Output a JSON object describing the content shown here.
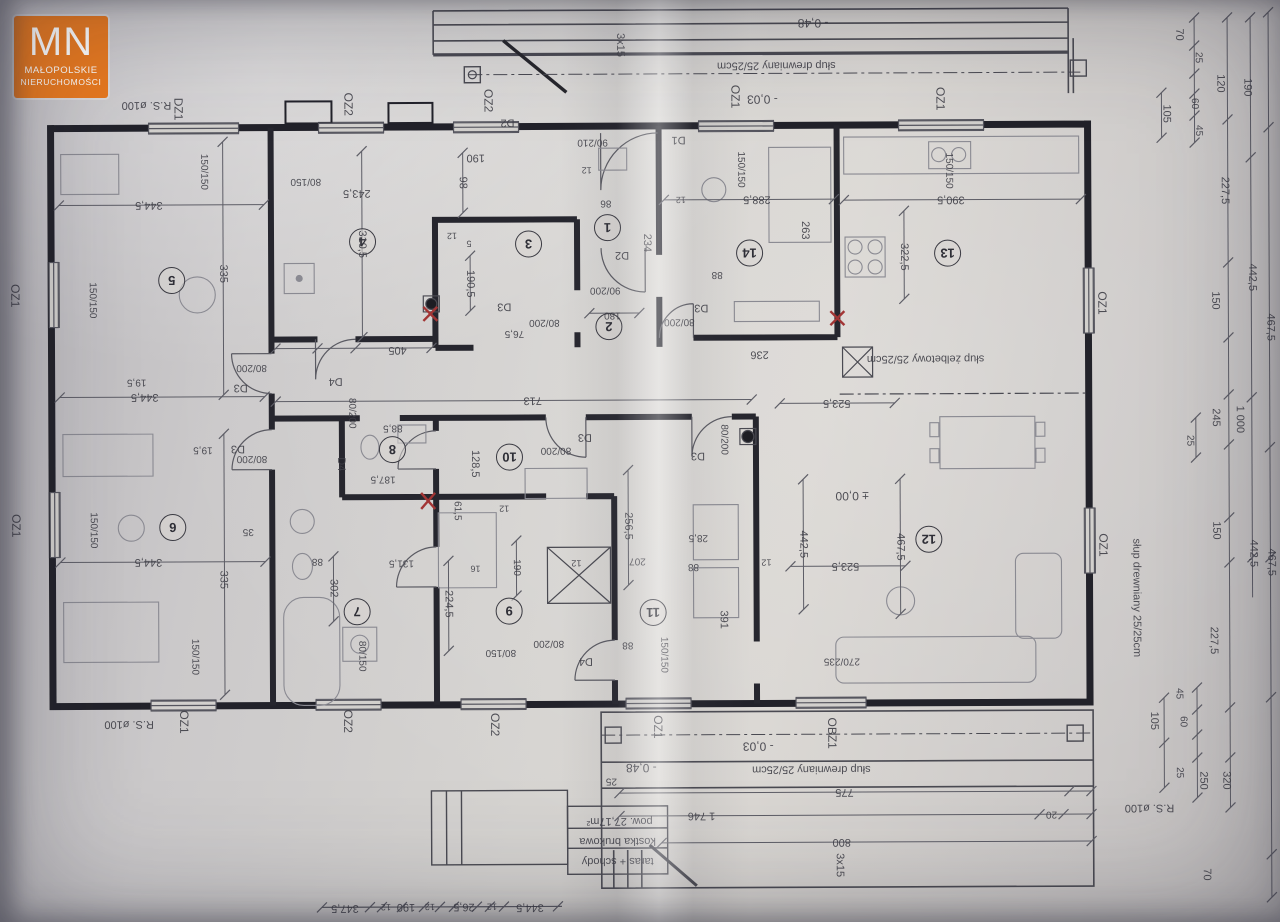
{
  "logo": {
    "initials": "MN",
    "line1": "MAŁOPOLSKIE",
    "line2": "NIERUCHOMOŚCI"
  },
  "colors": {
    "paper": "#d6d4d1",
    "ink": "#3f3f47",
    "wall": "#22222a",
    "accent": "#e8791f",
    "red": "#a23535"
  },
  "rooms": [
    {
      "n": "1",
      "x": 608,
      "y": 227
    },
    {
      "n": "2",
      "x": 609,
      "y": 326
    },
    {
      "n": "3",
      "x": 529,
      "y": 243
    },
    {
      "n": "4",
      "x": 363,
      "y": 240
    },
    {
      "n": "5",
      "x": 172,
      "y": 278
    },
    {
      "n": "6",
      "x": 172,
      "y": 525
    },
    {
      "n": "7",
      "x": 356,
      "y": 610
    },
    {
      "n": "8",
      "x": 392,
      "y": 448
    },
    {
      "n": "9",
      "x": 508,
      "y": 610
    },
    {
      "n": "10",
      "x": 509,
      "y": 456
    },
    {
      "n": "11",
      "x": 652,
      "y": 612
    },
    {
      "n": "12",
      "x": 928,
      "y": 540
    },
    {
      "n": "13",
      "x": 948,
      "y": 254
    },
    {
      "n": "14",
      "x": 750,
      "y": 253
    }
  ],
  "labels": [
    {
      "t": "R.S. ø100",
      "x": 148,
      "y": 103,
      "r": 180,
      "s": 11
    },
    {
      "t": "DZ1",
      "x": 180,
      "y": 107,
      "r": 90,
      "s": 12
    },
    {
      "t": "OZ2",
      "x": 350,
      "y": 103,
      "r": 90,
      "s": 12
    },
    {
      "t": "OZ2",
      "x": 490,
      "y": 100,
      "r": 90,
      "s": 12
    },
    {
      "t": "OZ1",
      "x": 737,
      "y": 97,
      "r": 90,
      "s": 12
    },
    {
      "t": "OZ1",
      "x": 942,
      "y": 100,
      "r": 90,
      "s": 12
    },
    {
      "t": "3x15",
      "x": 622,
      "y": 45,
      "r": 90,
      "s": 11
    },
    {
      "t": "- 0,48",
      "x": 815,
      "y": 24,
      "r": 180,
      "s": 12
    },
    {
      "t": "słup drewniany 25/25cm",
      "x": 778,
      "y": 66,
      "r": 180,
      "s": 11
    },
    {
      "t": "- 0,03",
      "x": 764,
      "y": 100,
      "r": 180,
      "s": 12
    },
    {
      "t": "90/210",
      "x": 594,
      "y": 142,
      "r": 180,
      "s": 10
    },
    {
      "t": "OZ1",
      "x": 16,
      "y": 293,
      "r": 90,
      "s": 12
    },
    {
      "t": "OZ1",
      "x": 16,
      "y": 523,
      "r": 90,
      "s": 12
    },
    {
      "t": "OZ1",
      "x": 1103,
      "y": 305,
      "r": 90,
      "s": 12
    },
    {
      "t": "OZ1",
      "x": 1103,
      "y": 547,
      "r": 90,
      "s": 12
    },
    {
      "t": "słup drewniany 25/25cm",
      "x": 1136,
      "y": 600,
      "r": 90,
      "s": 11
    },
    {
      "t": "70",
      "x": 1181,
      "y": 37,
      "r": 90,
      "s": 11
    },
    {
      "t": "25",
      "x": 1200,
      "y": 60,
      "r": 90,
      "s": 10
    },
    {
      "t": "120",
      "x": 1222,
      "y": 86,
      "r": 90,
      "s": 11
    },
    {
      "t": "190",
      "x": 1249,
      "y": 90,
      "r": 90,
      "s": 11
    },
    {
      "t": "60",
      "x": 1196,
      "y": 106,
      "r": 90,
      "s": 10
    },
    {
      "t": "105",
      "x": 1168,
      "y": 116,
      "r": 90,
      "s": 11
    },
    {
      "t": "45",
      "x": 1200,
      "y": 133,
      "r": 90,
      "s": 10
    },
    {
      "t": "227,5",
      "x": 1226,
      "y": 193,
      "r": 90,
      "s": 11
    },
    {
      "t": "442,5",
      "x": 1253,
      "y": 280,
      "r": 90,
      "s": 11
    },
    {
      "t": "467,5",
      "x": 1271,
      "y": 330,
      "r": 90,
      "s": 11
    },
    {
      "t": "150",
      "x": 1216,
      "y": 303,
      "r": 90,
      "s": 11
    },
    {
      "t": "245",
      "x": 1216,
      "y": 420,
      "r": 90,
      "s": 11
    },
    {
      "t": "25",
      "x": 1190,
      "y": 443,
      "r": 90,
      "s": 10
    },
    {
      "t": "1 000",
      "x": 1240,
      "y": 422,
      "r": 90,
      "s": 11
    },
    {
      "t": "150",
      "x": 1216,
      "y": 533,
      "r": 90,
      "s": 11
    },
    {
      "t": "442,5",
      "x": 1253,
      "y": 556,
      "r": 90,
      "s": 11
    },
    {
      "t": "467,5",
      "x": 1271,
      "y": 565,
      "r": 90,
      "s": 11
    },
    {
      "t": "227,5",
      "x": 1213,
      "y": 643,
      "r": 90,
      "s": 11
    },
    {
      "t": "45",
      "x": 1178,
      "y": 696,
      "r": 90,
      "s": 10
    },
    {
      "t": "60",
      "x": 1182,
      "y": 724,
      "r": 90,
      "s": 10
    },
    {
      "t": "105",
      "x": 1153,
      "y": 723,
      "r": 90,
      "s": 11
    },
    {
      "t": "25",
      "x": 1178,
      "y": 775,
      "r": 90,
      "s": 10
    },
    {
      "t": "250",
      "x": 1202,
      "y": 783,
      "r": 90,
      "s": 11
    },
    {
      "t": "320",
      "x": 1225,
      "y": 783,
      "r": 90,
      "s": 11
    },
    {
      "t": "70",
      "x": 1205,
      "y": 877,
      "r": 90,
      "s": 11
    },
    {
      "t": "R.S. ø100",
      "x": 1148,
      "y": 810,
      "r": 180,
      "s": 11
    },
    {
      "t": "OZ1",
      "x": 183,
      "y": 720,
      "r": 90,
      "s": 12
    },
    {
      "t": "R.S. ø100",
      "x": 128,
      "y": 722,
      "r": 180,
      "s": 11
    },
    {
      "t": "OZ2",
      "x": 347,
      "y": 720,
      "r": 90,
      "s": 12
    },
    {
      "t": "OZ2",
      "x": 494,
      "y": 724,
      "r": 90,
      "s": 12
    },
    {
      "t": "OZ1",
      "x": 657,
      "y": 727,
      "r": 90,
      "s": 12
    },
    {
      "t": "OBZ1",
      "x": 831,
      "y": 734,
      "r": 90,
      "s": 12
    },
    {
      "t": "- 0,48",
      "x": 640,
      "y": 768,
      "r": 180,
      "s": 12
    },
    {
      "t": "25",
      "x": 610,
      "y": 781,
      "r": 180,
      "s": 10
    },
    {
      "t": "słup drewniany 25/25cm",
      "x": 810,
      "y": 770,
      "r": 180,
      "s": 11
    },
    {
      "t": "- 0,03",
      "x": 757,
      "y": 747,
      "r": 180,
      "s": 12
    },
    {
      "t": "775",
      "x": 843,
      "y": 793,
      "r": 180,
      "s": 11
    },
    {
      "t": "1 746",
      "x": 700,
      "y": 816,
      "r": 180,
      "s": 11
    },
    {
      "t": "800",
      "x": 840,
      "y": 843,
      "r": 180,
      "s": 11
    },
    {
      "t": "20",
      "x": 1050,
      "y": 816,
      "r": 180,
      "s": 10
    },
    {
      "t": "3x15",
      "x": 838,
      "y": 866,
      "r": 90,
      "s": 11
    },
    {
      "t": "taras + schody",
      "x": 616,
      "y": 861,
      "r": 180,
      "s": 11
    },
    {
      "t": "kostka brukowa",
      "x": 616,
      "y": 841,
      "r": 180,
      "s": 11
    },
    {
      "t": "pow. 27,17m²",
      "x": 618,
      "y": 821,
      "r": 180,
      "s": 11
    },
    {
      "t": "347,5",
      "x": 343,
      "y": 907,
      "r": 180,
      "s": 11
    },
    {
      "t": "12",
      "x": 384,
      "y": 906,
      "r": 180,
      "s": 9
    },
    {
      "t": "190",
      "x": 404,
      "y": 906,
      "r": 180,
      "s": 11
    },
    {
      "t": "12",
      "x": 428,
      "y": 906,
      "r": 180,
      "s": 9
    },
    {
      "t": "26,5",
      "x": 462,
      "y": 906,
      "r": 180,
      "s": 11
    },
    {
      "t": "12",
      "x": 490,
      "y": 906,
      "r": 180,
      "s": 9
    },
    {
      "t": "344,5",
      "x": 528,
      "y": 907,
      "r": 180,
      "s": 11
    },
    {
      "t": "344,5",
      "x": 150,
      "y": 203,
      "r": 180,
      "s": 11
    },
    {
      "t": "335",
      "x": 224,
      "y": 272,
      "r": 90,
      "s": 11
    },
    {
      "t": "150/150",
      "x": 205,
      "y": 170,
      "r": 90,
      "s": 10
    },
    {
      "t": "150/150",
      "x": 93,
      "y": 298,
      "r": 90,
      "s": 10
    },
    {
      "t": "344,5",
      "x": 145,
      "y": 395,
      "r": 180,
      "s": 11
    },
    {
      "t": "19,5",
      "x": 137,
      "y": 380,
      "r": 180,
      "s": 10
    },
    {
      "t": "D3",
      "x": 241,
      "y": 386,
      "r": 180,
      "s": 11
    },
    {
      "t": "80/200",
      "x": 252,
      "y": 366,
      "r": 180,
      "s": 10
    },
    {
      "t": "344,5",
      "x": 148,
      "y": 560,
      "r": 180,
      "s": 11
    },
    {
      "t": "335",
      "x": 223,
      "y": 578,
      "r": 90,
      "s": 11
    },
    {
      "t": "150/150",
      "x": 93,
      "y": 528,
      "r": 90,
      "s": 10
    },
    {
      "t": "150/150",
      "x": 194,
      "y": 655,
      "r": 90,
      "s": 10
    },
    {
      "t": "19,5",
      "x": 203,
      "y": 448,
      "r": 180,
      "s": 10
    },
    {
      "t": "D3",
      "x": 238,
      "y": 447,
      "r": 180,
      "s": 11
    },
    {
      "t": "80/200",
      "x": 252,
      "y": 457,
      "r": 180,
      "s": 10
    },
    {
      "t": "35",
      "x": 248,
      "y": 530,
      "r": 180,
      "s": 10
    },
    {
      "t": "405",
      "x": 398,
      "y": 349,
      "r": 180,
      "s": 11
    },
    {
      "t": "713",
      "x": 533,
      "y": 400,
      "r": 180,
      "s": 11
    },
    {
      "t": "D4",
      "x": 336,
      "y": 380,
      "r": 180,
      "s": 11
    },
    {
      "t": "80/200",
      "x": 352,
      "y": 412,
      "r": 90,
      "s": 10
    },
    {
      "t": "243,5",
      "x": 358,
      "y": 192,
      "r": 180,
      "s": 11
    },
    {
      "t": "310,5",
      "x": 363,
      "y": 243,
      "r": 90,
      "s": 11
    },
    {
      "t": "80/150",
      "x": 307,
      "y": 180,
      "r": 180,
      "s": 10
    },
    {
      "t": "98",
      "x": 464,
      "y": 182,
      "r": 90,
      "s": 11
    },
    {
      "t": "190",
      "x": 477,
      "y": 157,
      "r": 180,
      "s": 11
    },
    {
      "t": "12",
      "x": 453,
      "y": 235,
      "r": 180,
      "s": 9
    },
    {
      "t": "5",
      "x": 470,
      "y": 243,
      "r": 180,
      "s": 9
    },
    {
      "t": "190,5",
      "x": 471,
      "y": 283,
      "r": 90,
      "s": 11
    },
    {
      "t": "D3",
      "x": 505,
      "y": 306,
      "r": 180,
      "s": 11
    },
    {
      "t": "80/200",
      "x": 545,
      "y": 322,
      "r": 180,
      "s": 10
    },
    {
      "t": "76,5",
      "x": 515,
      "y": 333,
      "r": 180,
      "s": 10
    },
    {
      "t": "D2",
      "x": 509,
      "y": 122,
      "r": 180,
      "s": 11
    },
    {
      "t": "86",
      "x": 607,
      "y": 203,
      "r": 180,
      "s": 10
    },
    {
      "t": "234",
      "x": 648,
      "y": 243,
      "r": 90,
      "s": 11
    },
    {
      "t": "D1",
      "x": 680,
      "y": 140,
      "r": 180,
      "s": 11
    },
    {
      "t": "12",
      "x": 588,
      "y": 170,
      "r": 180,
      "s": 9
    },
    {
      "t": "D2",
      "x": 623,
      "y": 255,
      "r": 180,
      "s": 11
    },
    {
      "t": "90/200",
      "x": 606,
      "y": 290,
      "r": 180,
      "s": 10
    },
    {
      "t": "180",
      "x": 613,
      "y": 315,
      "r": 180,
      "s": 10
    },
    {
      "t": "288,5",
      "x": 758,
      "y": 200,
      "r": 180,
      "s": 11
    },
    {
      "t": "150/150",
      "x": 742,
      "y": 170,
      "r": 90,
      "s": 10
    },
    {
      "t": "263",
      "x": 806,
      "y": 231,
      "r": 90,
      "s": 11
    },
    {
      "t": "12",
      "x": 682,
      "y": 200,
      "r": 180,
      "s": 9
    },
    {
      "t": "88",
      "x": 718,
      "y": 275,
      "r": 180,
      "s": 10
    },
    {
      "t": "D3",
      "x": 702,
      "y": 308,
      "r": 180,
      "s": 11
    },
    {
      "t": "80/200",
      "x": 680,
      "y": 322,
      "r": 180,
      "s": 10
    },
    {
      "t": "236",
      "x": 760,
      "y": 355,
      "r": 180,
      "s": 11
    },
    {
      "t": "390,5",
      "x": 952,
      "y": 201,
      "r": 180,
      "s": 11
    },
    {
      "t": "322,5",
      "x": 905,
      "y": 258,
      "r": 90,
      "s": 11
    },
    {
      "t": "150/150",
      "x": 950,
      "y": 172,
      "r": 90,
      "s": 10
    },
    {
      "t": "słup żelbetowy 25/25cm",
      "x": 926,
      "y": 360,
      "r": 180,
      "s": 11
    },
    {
      "t": "523,5",
      "x": 837,
      "y": 404,
      "r": 180,
      "s": 11
    },
    {
      "t": "± 0,00",
      "x": 852,
      "y": 497,
      "r": 180,
      "s": 12
    },
    {
      "t": "442,5",
      "x": 803,
      "y": 545,
      "r": 90,
      "s": 11
    },
    {
      "t": "523,5",
      "x": 845,
      "y": 567,
      "r": 180,
      "s": 11
    },
    {
      "t": "467,5",
      "x": 900,
      "y": 548,
      "r": 90,
      "s": 11
    },
    {
      "t": "270/235",
      "x": 841,
      "y": 662,
      "r": 180,
      "s": 10
    },
    {
      "t": "28,5",
      "x": 698,
      "y": 538,
      "r": 180,
      "s": 10
    },
    {
      "t": "88",
      "x": 693,
      "y": 567,
      "r": 180,
      "s": 10
    },
    {
      "t": "391",
      "x": 723,
      "y": 620,
      "r": 90,
      "s": 11
    },
    {
      "t": "12",
      "x": 766,
      "y": 563,
      "r": 180,
      "s": 9
    },
    {
      "t": "D3",
      "x": 698,
      "y": 456,
      "r": 180,
      "s": 11
    },
    {
      "t": "80/200",
      "x": 724,
      "y": 440,
      "r": 90,
      "s": 10
    },
    {
      "t": "256,5",
      "x": 628,
      "y": 526,
      "r": 90,
      "s": 11
    },
    {
      "t": "207",
      "x": 637,
      "y": 561,
      "r": 180,
      "s": 10
    },
    {
      "t": "88",
      "x": 627,
      "y": 645,
      "r": 180,
      "s": 10
    },
    {
      "t": "80/150",
      "x": 500,
      "y": 652,
      "r": 180,
      "s": 10
    },
    {
      "t": "80/200",
      "x": 548,
      "y": 643,
      "r": 180,
      "s": 10
    },
    {
      "t": "D4",
      "x": 585,
      "y": 661,
      "r": 180,
      "s": 11
    },
    {
      "t": "224,5",
      "x": 448,
      "y": 603,
      "r": 90,
      "s": 11
    },
    {
      "t": "16",
      "x": 475,
      "y": 568,
      "r": 180,
      "s": 9
    },
    {
      "t": "61,5",
      "x": 457,
      "y": 510,
      "r": 90,
      "s": 10
    },
    {
      "t": "190",
      "x": 516,
      "y": 567,
      "r": 90,
      "s": 10
    },
    {
      "t": "12",
      "x": 576,
      "y": 563,
      "r": 180,
      "s": 9
    },
    {
      "t": "128,5",
      "x": 475,
      "y": 463,
      "r": 90,
      "s": 11
    },
    {
      "t": "80/200",
      "x": 556,
      "y": 450,
      "r": 180,
      "s": 10
    },
    {
      "t": "D3",
      "x": 585,
      "y": 437,
      "r": 180,
      "s": 11
    },
    {
      "t": "88,5",
      "x": 393,
      "y": 427,
      "r": 180,
      "s": 10
    },
    {
      "t": "187,5",
      "x": 383,
      "y": 478,
      "r": 180,
      "s": 10
    },
    {
      "t": "302",
      "x": 333,
      "y": 587,
      "r": 90,
      "s": 11
    },
    {
      "t": "88",
      "x": 317,
      "y": 560,
      "r": 180,
      "s": 10
    },
    {
      "t": "131,5",
      "x": 401,
      "y": 562,
      "r": 180,
      "s": 10
    },
    {
      "t": "80/150",
      "x": 361,
      "y": 655,
      "r": 90,
      "s": 10
    },
    {
      "t": "12",
      "x": 504,
      "y": 508,
      "r": 180,
      "s": 9
    },
    {
      "t": "D4",
      "x": 341,
      "y": 463,
      "r": 90,
      "s": 11
    },
    {
      "t": "150/150",
      "x": 663,
      "y": 655,
      "r": 90,
      "s": 10
    }
  ]
}
